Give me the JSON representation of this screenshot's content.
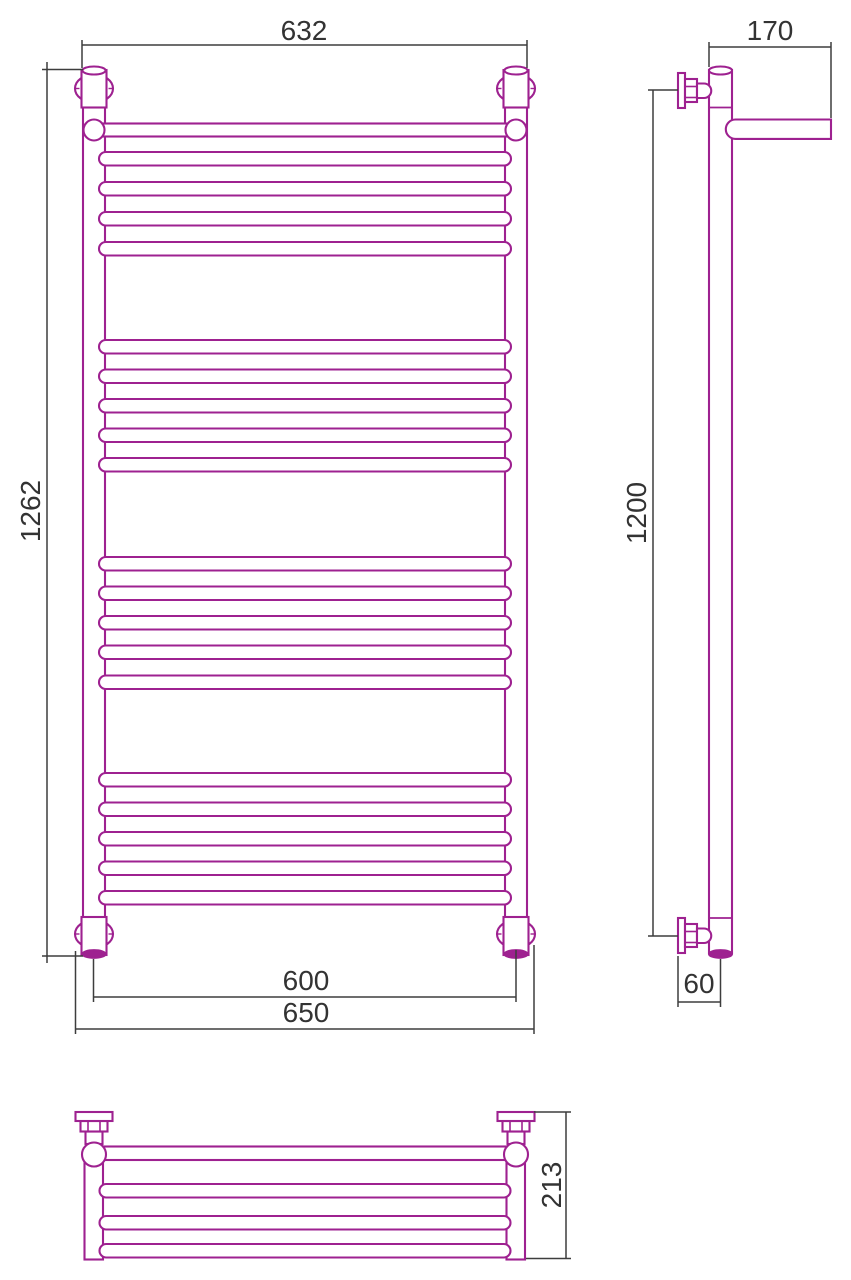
{
  "page": {
    "background": "#ffffff"
  },
  "canvas": {
    "width": 851,
    "height": 1280
  },
  "colors": {
    "object": "#9E2190",
    "dimension": "#3D3D3D",
    "text": "#333333",
    "background": "#FFFFFF"
  },
  "views": [
    {
      "name": "front-view",
      "shapes": [
        {
          "t": "rect",
          "n": "left-tube",
          "x": 83,
          "y": 70,
          "w": 22,
          "h": 883
        },
        {
          "t": "rect",
          "n": "right-tube",
          "x": 505,
          "y": 70,
          "w": 22,
          "h": 883
        },
        {
          "t": "rect",
          "n": "rung",
          "x": 99,
          "y": 152,
          "w": 412,
          "h": 13.5,
          "rx": 6.75
        },
        {
          "t": "rect",
          "n": "rung",
          "x": 99,
          "y": 182,
          "w": 412,
          "h": 13.5,
          "rx": 6.75
        },
        {
          "t": "rect",
          "n": "rung",
          "x": 99,
          "y": 212,
          "w": 412,
          "h": 13.5,
          "rx": 6.75
        },
        {
          "t": "rect",
          "n": "rung",
          "x": 99,
          "y": 242,
          "w": 412,
          "h": 13.5,
          "rx": 6.75
        },
        {
          "t": "rect",
          "n": "rung",
          "x": 99,
          "y": 340,
          "w": 412,
          "h": 13.5,
          "rx": 6.75
        },
        {
          "t": "rect",
          "n": "rung",
          "x": 99,
          "y": 369.5,
          "w": 412,
          "h": 13.5,
          "rx": 6.75
        },
        {
          "t": "rect",
          "n": "rung",
          "x": 99,
          "y": 399,
          "w": 412,
          "h": 13.5,
          "rx": 6.75
        },
        {
          "t": "rect",
          "n": "rung",
          "x": 99,
          "y": 428.5,
          "w": 412,
          "h": 13.5,
          "rx": 6.75
        },
        {
          "t": "rect",
          "n": "rung",
          "x": 99,
          "y": 458,
          "w": 412,
          "h": 13.5,
          "rx": 6.75
        },
        {
          "t": "rect",
          "n": "rung",
          "x": 99,
          "y": 557,
          "w": 412,
          "h": 13.5,
          "rx": 6.75
        },
        {
          "t": "rect",
          "n": "rung",
          "x": 99,
          "y": 586.5,
          "w": 412,
          "h": 13.5,
          "rx": 6.75
        },
        {
          "t": "rect",
          "n": "rung",
          "x": 99,
          "y": 616,
          "w": 412,
          "h": 13.5,
          "rx": 6.75
        },
        {
          "t": "rect",
          "n": "rung",
          "x": 99,
          "y": 645.5,
          "w": 412,
          "h": 13.5,
          "rx": 6.75
        },
        {
          "t": "rect",
          "n": "rung",
          "x": 99,
          "y": 675.5,
          "w": 412,
          "h": 13.5,
          "rx": 6.75
        },
        {
          "t": "rect",
          "n": "rung",
          "x": 99,
          "y": 773,
          "w": 412,
          "h": 13.5,
          "rx": 6.75
        },
        {
          "t": "rect",
          "n": "rung",
          "x": 99,
          "y": 802.5,
          "w": 412,
          "h": 13.5,
          "rx": 6.75
        },
        {
          "t": "rect",
          "n": "rung",
          "x": 99,
          "y": 832,
          "w": 412,
          "h": 13.5,
          "rx": 6.75
        },
        {
          "t": "rect",
          "n": "rung",
          "x": 99,
          "y": 861.5,
          "w": 412,
          "h": 13.5,
          "rx": 6.75
        },
        {
          "t": "rect",
          "n": "rung",
          "x": 99,
          "y": 891,
          "w": 412,
          "h": 13.5,
          "rx": 6.75
        },
        {
          "t": "rect",
          "n": "shelf-front-bar",
          "x": 94,
          "y": 123.5,
          "w": 422,
          "h": 13
        },
        {
          "t": "circle",
          "n": "shelf-ball-joint-left",
          "cx": 94,
          "cy": 130,
          "r": 10.5
        },
        {
          "t": "circle",
          "n": "shelf-ball-joint-right",
          "cx": 516,
          "cy": 130,
          "r": 10.5
        },
        {
          "t": "ellipse",
          "n": "escutcheon-top-left",
          "cx": 94,
          "cy": 88.5,
          "rx": 19,
          "ry": 14
        },
        {
          "t": "line",
          "n": "escutcheon-tick",
          "x1": 74,
          "y1": 88.5,
          "x2": 79.5,
          "y2": 88.5,
          "sw": 1.4
        },
        {
          "t": "line",
          "n": "escutcheon-tick",
          "x1": 108.5,
          "y1": 88.5,
          "x2": 114,
          "y2": 88.5,
          "sw": 1.4
        },
        {
          "t": "rect",
          "n": "collar-top-left",
          "x": 81.5,
          "y": 70,
          "w": 25,
          "h": 37.5
        },
        {
          "t": "ellipse",
          "n": "tube-cap-top-left",
          "cx": 94,
          "cy": 70.5,
          "rx": 11.5,
          "ry": 4
        },
        {
          "t": "ellipse",
          "n": "escutcheon-top-right",
          "cx": 516,
          "cy": 88.5,
          "rx": 19,
          "ry": 14
        },
        {
          "t": "line",
          "n": "escutcheon-tick",
          "x1": 496,
          "y1": 88.5,
          "x2": 501.5,
          "y2": 88.5,
          "sw": 1.4
        },
        {
          "t": "line",
          "n": "escutcheon-tick",
          "x1": 530.5,
          "y1": 88.5,
          "x2": 536,
          "y2": 88.5,
          "sw": 1.4
        },
        {
          "t": "rect",
          "n": "collar-top-right",
          "x": 503.5,
          "y": 70,
          "w": 25,
          "h": 37.5
        },
        {
          "t": "ellipse",
          "n": "tube-cap-top-right",
          "cx": 516,
          "cy": 70.5,
          "rx": 11.5,
          "ry": 4
        },
        {
          "t": "ellipse",
          "n": "escutcheon-bottom-left",
          "cx": 94,
          "cy": 934,
          "rx": 19,
          "ry": 14
        },
        {
          "t": "line",
          "n": "escutcheon-tick",
          "x1": 74,
          "y1": 934,
          "x2": 79.5,
          "y2": 934,
          "sw": 1.4
        },
        {
          "t": "line",
          "n": "escutcheon-tick",
          "x1": 108.5,
          "y1": 934,
          "x2": 114,
          "y2": 934,
          "sw": 1.4
        },
        {
          "t": "rect",
          "n": "collar-bottom-left",
          "x": 81.5,
          "y": 917,
          "w": 25,
          "h": 38
        },
        {
          "t": "ellipse",
          "n": "tube-cap-bottom-left",
          "cx": 94,
          "cy": 954,
          "rx": 11.5,
          "ry": 3.8,
          "f": "obj"
        },
        {
          "t": "ellipse",
          "n": "escutcheon-bottom-right",
          "cx": 516,
          "cy": 934,
          "rx": 19,
          "ry": 14
        },
        {
          "t": "line",
          "n": "escutcheon-tick",
          "x1": 496,
          "y1": 934,
          "x2": 501.5,
          "y2": 934,
          "sw": 1.4
        },
        {
          "t": "line",
          "n": "escutcheon-tick",
          "x1": 530.5,
          "y1": 934,
          "x2": 536,
          "y2": 934,
          "sw": 1.4
        },
        {
          "t": "rect",
          "n": "collar-bottom-right",
          "x": 503.5,
          "y": 917,
          "w": 25,
          "h": 38
        },
        {
          "t": "ellipse",
          "n": "tube-cap-bottom-right",
          "cx": 516,
          "cy": 954,
          "rx": 11.5,
          "ry": 3.8,
          "f": "obj"
        }
      ]
    },
    {
      "name": "side-view",
      "shapes": [
        {
          "t": "rect",
          "n": "tube",
          "x": 709,
          "y": 70,
          "w": 23,
          "h": 883
        },
        {
          "t": "line",
          "n": "tube-joint",
          "x1": 709,
          "y1": 107.5,
          "x2": 732,
          "y2": 107.5,
          "sw": 1.8
        },
        {
          "t": "line",
          "n": "tube-joint",
          "x1": 709,
          "y1": 918,
          "x2": 732,
          "y2": 918,
          "sw": 1.8
        },
        {
          "t": "ellipse",
          "n": "tube-cap-top",
          "cx": 720.5,
          "cy": 70.5,
          "rx": 11.5,
          "ry": 4
        },
        {
          "t": "ellipse",
          "n": "tube-cap-bottom",
          "cx": 720.5,
          "cy": 954,
          "rx": 11.5,
          "ry": 3.8,
          "f": "obj"
        },
        {
          "t": "path",
          "n": "shelf-bar-side",
          "d": "M831,119.5 H735.5 A9.7,9.7 0 0 0 735.5,138.9 H831 Z"
        },
        {
          "t": "rect",
          "n": "valve-flange-top",
          "x": 678,
          "y": 73,
          "w": 7,
          "h": 35
        },
        {
          "t": "rect",
          "n": "valve-nut-top",
          "x": 685,
          "y": 79,
          "w": 12,
          "h": 23
        },
        {
          "t": "line",
          "n": "valve-nut-facet",
          "x1": 685,
          "y1": 86.5,
          "x2": 697,
          "y2": 86.5,
          "sw": 1.6
        },
        {
          "t": "line",
          "n": "valve-nut-facet",
          "x1": 685,
          "y1": 97.5,
          "x2": 697,
          "y2": 97.5,
          "sw": 1.6
        },
        {
          "t": "path",
          "n": "valve-plug-top",
          "d": "M697,83.5 H704 A7.25,7.25 0 0 1 704,98 H697 Z"
        },
        {
          "t": "rect",
          "n": "valve-flange-bottom",
          "x": 678,
          "y": 918,
          "w": 7,
          "h": 35
        },
        {
          "t": "rect",
          "n": "valve-nut-bottom",
          "x": 685,
          "y": 924,
          "w": 12,
          "h": 23
        },
        {
          "t": "line",
          "n": "valve-nut-facet",
          "x1": 685,
          "y1": 931.5,
          "x2": 697,
          "y2": 931.5,
          "sw": 1.6
        },
        {
          "t": "line",
          "n": "valve-nut-facet",
          "x1": 685,
          "y1": 942.5,
          "x2": 697,
          "y2": 942.5,
          "sw": 1.6
        },
        {
          "t": "path",
          "n": "valve-plug-bottom",
          "d": "M697,928.5 H704 A7.25,7.25 0 0 1 704,943 H697 Z"
        }
      ]
    },
    {
      "name": "top-view",
      "shapes": [
        {
          "t": "rect",
          "n": "left-tube",
          "x": 84.5,
          "y": 1150,
          "w": 18.5,
          "h": 109.5
        },
        {
          "t": "rect",
          "n": "right-tube",
          "x": 506.5,
          "y": 1150,
          "w": 18.5,
          "h": 109.5
        },
        {
          "t": "rect",
          "n": "shelf-front-bar",
          "x": 94,
          "y": 1146.5,
          "w": 422,
          "h": 13.5
        },
        {
          "t": "rect",
          "n": "shelf-bar",
          "x": 99.5,
          "y": 1184,
          "w": 411,
          "h": 13.5,
          "rx": 6.75
        },
        {
          "t": "rect",
          "n": "shelf-bar",
          "x": 99.5,
          "y": 1216,
          "w": 411,
          "h": 13.5,
          "rx": 6.75
        },
        {
          "t": "rect",
          "n": "shelf-bar",
          "x": 99.5,
          "y": 1244,
          "w": 411,
          "h": 13.5,
          "rx": 6.75
        },
        {
          "t": "rect",
          "n": "valve-neck-left",
          "x": 85.5,
          "y": 1131.5,
          "w": 17,
          "h": 12.5
        },
        {
          "t": "rect",
          "n": "valve-neck-right",
          "x": 507.5,
          "y": 1131.5,
          "w": 17,
          "h": 12.5
        },
        {
          "t": "circle",
          "n": "ball-joint-left",
          "cx": 94,
          "cy": 1154.5,
          "r": 12
        },
        {
          "t": "circle",
          "n": "ball-joint-right",
          "cx": 516,
          "cy": 1154.5,
          "r": 12
        },
        {
          "t": "rect",
          "n": "valve-nut-left",
          "x": 80.5,
          "y": 1121,
          "w": 27,
          "h": 10.5
        },
        {
          "t": "line",
          "n": "valve-nut-facet",
          "x1": 88,
          "y1": 1121,
          "x2": 88,
          "y2": 1131.5,
          "sw": 1.6
        },
        {
          "t": "line",
          "n": "valve-nut-facet",
          "x1": 100,
          "y1": 1121,
          "x2": 100,
          "y2": 1131.5,
          "sw": 1.6
        },
        {
          "t": "rect",
          "n": "valve-nut-right",
          "x": 502.5,
          "y": 1121,
          "w": 27,
          "h": 10.5
        },
        {
          "t": "line",
          "n": "valve-nut-facet",
          "x1": 510,
          "y1": 1121,
          "x2": 510,
          "y2": 1131.5,
          "sw": 1.6
        },
        {
          "t": "line",
          "n": "valve-nut-facet",
          "x1": 522,
          "y1": 1121,
          "x2": 522,
          "y2": 1131.5,
          "sw": 1.6
        },
        {
          "t": "rect",
          "n": "valve-flange-left",
          "x": 75.5,
          "y": 1112,
          "w": 37,
          "h": 9
        },
        {
          "t": "rect",
          "n": "valve-flange-right",
          "x": 497.5,
          "y": 1112,
          "w": 37,
          "h": 9
        }
      ]
    }
  ],
  "dimensions": [
    {
      "name": "overall-width",
      "value": "632",
      "label": {
        "x": 304,
        "y": 40,
        "rot": 0
      },
      "main": [
        82,
        45,
        527,
        45
      ],
      "ext": [
        [
          82,
          40,
          82,
          68
        ],
        [
          527,
          40,
          527,
          68
        ]
      ]
    },
    {
      "name": "overall-height",
      "value": "1262",
      "label": {
        "x": 40,
        "y": 511,
        "rot": 1
      },
      "main": [
        47,
        62,
        47,
        963
      ],
      "ext": [
        [
          42,
          69.5,
          83,
          69.5
        ],
        [
          42,
          956,
          83,
          956
        ]
      ]
    },
    {
      "name": "axle-spacing",
      "value": "600",
      "label": {
        "x": 306,
        "y": 990,
        "rot": 0
      },
      "main": [
        93.5,
        997,
        516,
        997
      ],
      "ext": [
        [
          93.5,
          959,
          93.5,
          1002
        ],
        [
          516,
          950,
          516,
          1002
        ]
      ]
    },
    {
      "name": "bracket-span",
      "value": "650",
      "label": {
        "x": 306,
        "y": 1022,
        "rot": 0
      },
      "main": [
        75.5,
        1029,
        534,
        1029
      ],
      "ext": [
        [
          75.5,
          951,
          75.5,
          1034
        ],
        [
          534,
          945,
          534,
          1034
        ]
      ]
    },
    {
      "name": "shelf-depth",
      "value": "170",
      "label": {
        "x": 770,
        "y": 40,
        "rot": 0
      },
      "main": [
        709,
        47,
        831,
        47
      ],
      "ext": [
        [
          709,
          42,
          709,
          67
        ],
        [
          831,
          42,
          831,
          118
        ]
      ]
    },
    {
      "name": "connection-height",
      "value": "1200",
      "label": {
        "x": 646,
        "y": 513,
        "rot": 1
      },
      "main": [
        653,
        90,
        653,
        936
      ],
      "ext": [
        [
          648,
          90,
          678,
          90
        ],
        [
          648,
          936,
          678,
          936
        ]
      ]
    },
    {
      "name": "wall-offset",
      "value": "60",
      "label": {
        "x": 699,
        "y": 993,
        "rot": 0
      },
      "main": [
        678,
        1002,
        720.5,
        1002
      ],
      "ext": [
        [
          678,
          956,
          678,
          1007
        ],
        [
          720.5,
          959,
          720.5,
          1007
        ]
      ]
    },
    {
      "name": "top-view-depth",
      "value": "213",
      "label": {
        "x": 561,
        "y": 1185,
        "rot": 1
      },
      "main": [
        566,
        1112,
        566,
        1258.5
      ],
      "ext": [
        [
          534,
          1112,
          571,
          1112
        ],
        [
          526,
          1258.5,
          571,
          1258.5
        ]
      ]
    }
  ]
}
